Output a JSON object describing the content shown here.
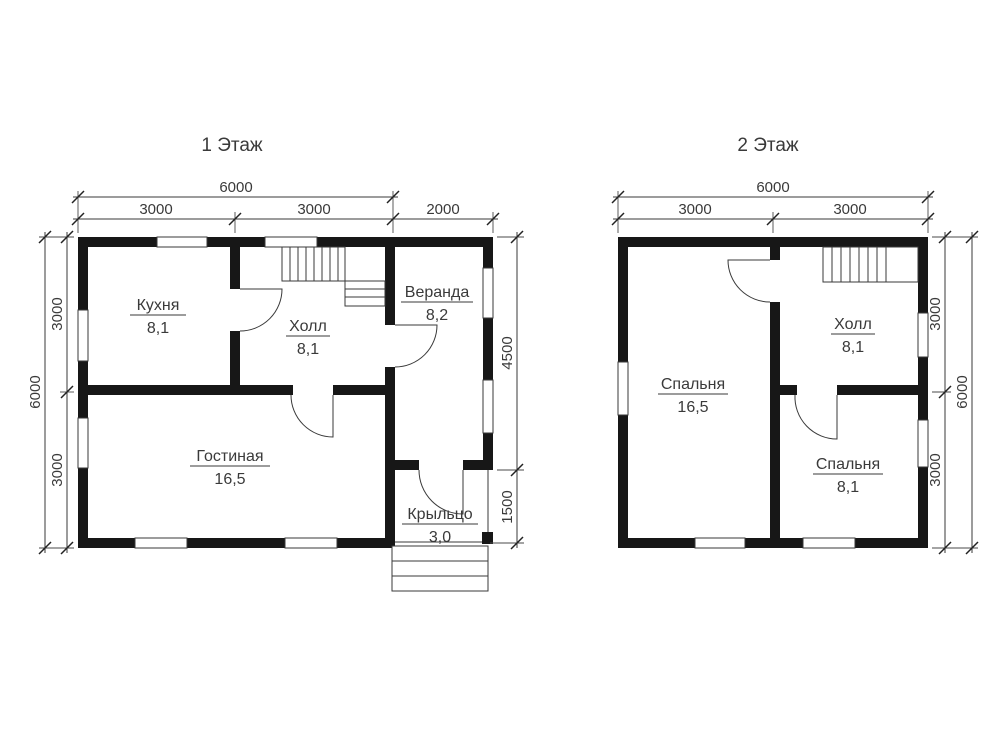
{
  "document": {
    "type": "house floor plan drawing",
    "background": "#ffffff",
    "wall_color": "#171717",
    "line_color": "#3a3a3a"
  },
  "floor1": {
    "title": "1 Этаж",
    "rooms": [
      {
        "name": "Кухня",
        "area": "8,1"
      },
      {
        "name": "Холл",
        "area": "8,1"
      },
      {
        "name": "Веранда",
        "area": "8,2"
      },
      {
        "name": "Гостиная",
        "area": "16,5"
      },
      {
        "name": "Крыльцо",
        "area": "3,0"
      }
    ],
    "dims": {
      "top_total": "6000",
      "top_seg1": "3000",
      "top_seg2": "3000",
      "top_seg3": "2000",
      "left_total": "6000",
      "left_seg1": "3000",
      "left_seg2": "3000",
      "right_seg1": "4500",
      "right_seg2": "1500"
    }
  },
  "floor2": {
    "title": "2 Этаж",
    "rooms": [
      {
        "name": "Спальня",
        "area": "16,5"
      },
      {
        "name": "Холл",
        "area": "8,1"
      },
      {
        "name": "Спальня",
        "area": "8,1"
      }
    ],
    "dims": {
      "top_total": "6000",
      "top_seg1": "3000",
      "top_seg2": "3000",
      "right_total": "6000",
      "right_seg1": "3000",
      "right_seg2": "3000"
    }
  }
}
